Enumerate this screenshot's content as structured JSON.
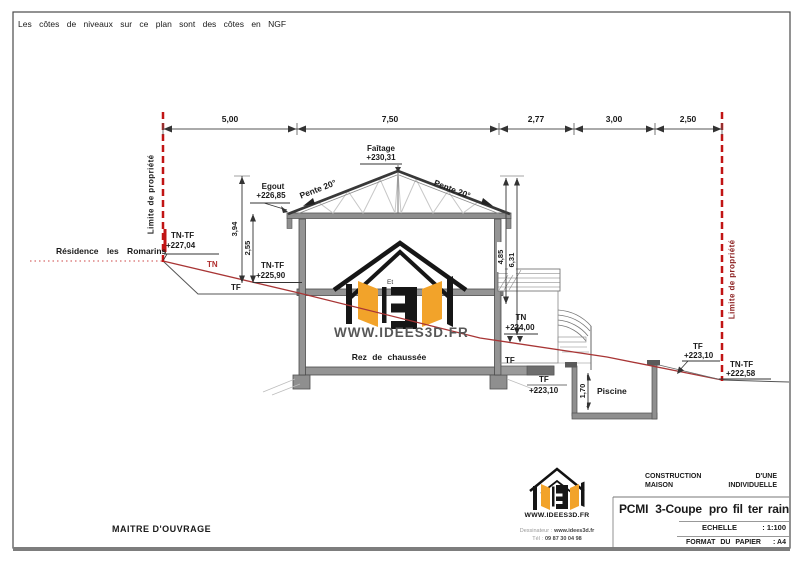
{
  "note": "Les côtes de niveaux sur ce plan sont des côtes en NGF",
  "dims": {
    "top": [
      "5,00",
      "7,50",
      "2,77",
      "3,00",
      "2,50"
    ],
    "v394": "3,94",
    "v255": "2,55",
    "v485": "4,85",
    "v631": "6,31",
    "v170": "1,70"
  },
  "site": {
    "limite_left": "Limite de propriété",
    "limite_right": "Limite de propriété",
    "residence": "Résidence les Romarins",
    "tn": "TN",
    "tf": "TF",
    "tf_mid": "TF",
    "tntf_left_label": "TN-TF",
    "tntf_left_value": "+227,04",
    "tntf_mid_label": "TN-TF",
    "tntf_mid_value": "+225,90",
    "tn224_label": "TN",
    "tn224_value": "+224,00",
    "tf223_left_label": "TF",
    "tf223_left_value": "+223,10",
    "tf223_right_label": "TF",
    "tf223_right_value": "+223,10",
    "tntf_right_label": "TN-TF",
    "tntf_right_value": "+222,58",
    "piscine": "Piscine"
  },
  "building": {
    "faitage_label": "Faîtage",
    "faitage_value": "+230,31",
    "egout_label": "Egout",
    "egout_value": "+226,85",
    "pente_left": "Pente 20°",
    "pente_right": "Pente 20°",
    "rdc": "Rez de chaussée"
  },
  "watermark": {
    "etage": "Et",
    "url": "WWW.IDEES3D.FR"
  },
  "titleblock": {
    "maitre": "MAITRE D'OUVRAGE",
    "logo_url": "WWW.IDEES3D.FR",
    "dessinateur_label": "Dessinateur :",
    "dessinateur_value": "www.idees3d.fr",
    "tel_label": "Tél :",
    "tel_value": "09 87 30 04 98",
    "construction_a": "CONSTRUCTION",
    "construction_b": "D'UNE",
    "maison_a": "MAISON",
    "maison_b": "INDIVIDUELLE",
    "doc_title_parts": [
      "PCMI",
      "3-Coupe",
      "pro fil ter rain"
    ],
    "echelle_label": "ECHELLE",
    "echelle_value": ": 1:100",
    "format_label": "FORMAT DU PAPIER",
    "format_value": ": A4"
  },
  "colors": {
    "property_red": "#c11414",
    "terrain_red": "#a83535",
    "logo_orange": "#f2a32a",
    "line_dark": "#3c3c3c",
    "fill_gray": "#949494",
    "limite_right_text": "#8e2525"
  },
  "icons": {
    "logo": "idees3d-house-logo",
    "logo_small": "idees3d-house-logo"
  }
}
